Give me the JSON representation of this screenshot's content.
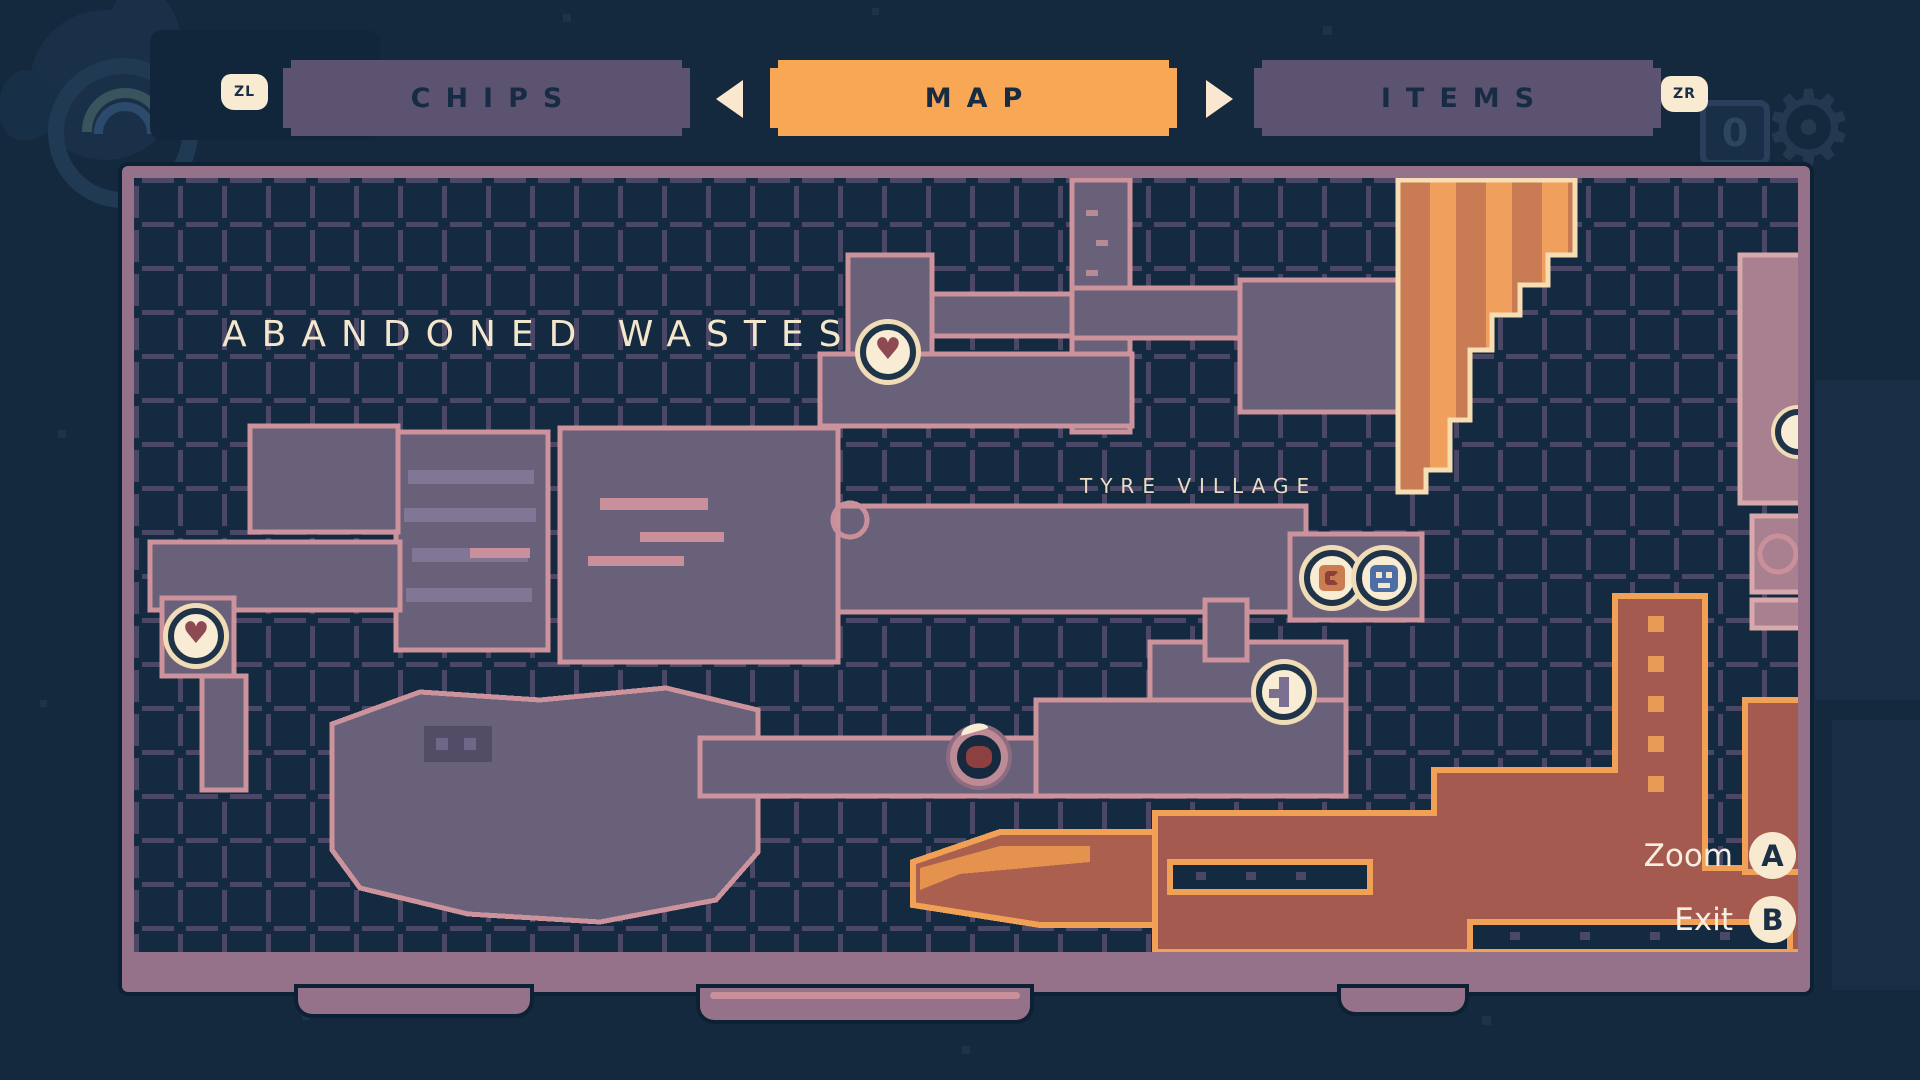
{
  "header": {
    "left_shoulder_label": "ZL",
    "right_shoulder_label": "ZR",
    "tabs": [
      {
        "label": "CHIPS",
        "active": false
      },
      {
        "label": "MAP",
        "active": true
      },
      {
        "label": "ITEMS",
        "active": false
      }
    ]
  },
  "map": {
    "region_title": "ABANDONED WASTES",
    "area_label": "TYRE VILLAGE",
    "icon_glyphs": {
      "health-station": "♥"
    },
    "markers": [
      {
        "type": "health-station",
        "x": 888,
        "y": 352
      },
      {
        "type": "health-station",
        "x": 196,
        "y": 636
      },
      {
        "type": "shop",
        "x": 1332,
        "y": 578
      },
      {
        "type": "save-station",
        "x": 1384,
        "y": 578
      },
      {
        "type": "ability",
        "x": 1284,
        "y": 692
      },
      {
        "type": "player-position",
        "x": 978,
        "y": 756
      },
      {
        "type": "edge-station",
        "x": 1798,
        "y": 432
      }
    ]
  },
  "actions": [
    {
      "label": "Zoom",
      "button": "A"
    },
    {
      "label": "Exit",
      "button": "B"
    }
  ],
  "decor": {
    "zero_label": "0",
    "gear_glyph": "⚙"
  },
  "colors": {
    "accent_orange": "#f8a855",
    "tab_inactive_purple": "#5c5370",
    "background_navy": "#14293d",
    "panel_frame_mauve": "#96718a",
    "room_purple": "#696179",
    "room_outline_pink": "#cc939c",
    "hazard_red": "#a55a50",
    "hazard_outline_orange": "#f0a155",
    "cream": "#f8ecd4",
    "grid_line": "#4b4766"
  }
}
